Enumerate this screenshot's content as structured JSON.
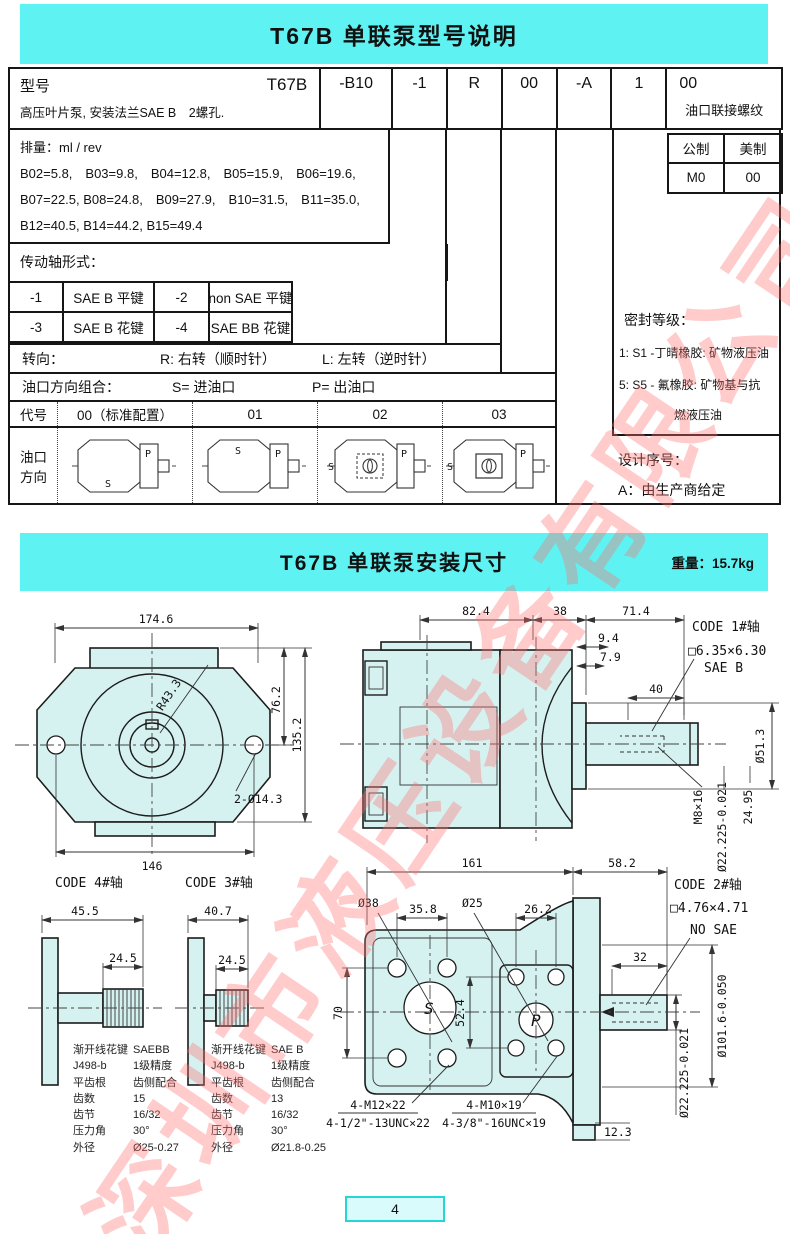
{
  "watermark": "深圳市液压设备有限公司",
  "section1": {
    "title": "T67B 单联泵型号说明",
    "header": {
      "model_label": "型号",
      "model_value": "T67B",
      "desc": "高压叶片泵, 安装法兰SAE B　2螺孔.",
      "codes": [
        "-B10",
        "-1",
        "R",
        "00",
        "-A",
        "1",
        "00"
      ],
      "port_thread_label": "油口联接螺纹"
    },
    "displacement": {
      "lines": [
        "排量：ml / rev",
        "B02=5.8,　B03=9.8,　B04=12.8,　B05=15.9,　B06=19.6,",
        "B07=22.5, B08=24.8,　B09=27.9,　B10=31.5,　B11=35.0,",
        "B12=40.5, B14=44.2, B15=49.4"
      ]
    },
    "shaft": {
      "label": "传动轴形式：",
      "rows": [
        [
          "-1",
          "SAE B 平键",
          "-2",
          "non SAE 平键"
        ],
        [
          "-3",
          "SAE B 花键",
          "-4",
          "SAE BB 花键"
        ]
      ]
    },
    "rotation": {
      "label": "转向：",
      "right": "R: 右转（顺时针）",
      "left": "L: 左转（逆时针）"
    },
    "ports": {
      "label": "油口方向组合：",
      "s": "S= 进油口",
      "p": "P= 出油口"
    },
    "code_row": [
      "代号",
      "00（标准配置）",
      "01",
      "02",
      "03"
    ],
    "port_dir_label_1": "油口",
    "port_dir_label_2": "方向",
    "port_letters": {
      "s": "S",
      "p": "P"
    },
    "thread_table": {
      "metric": "公制",
      "us": "美制",
      "metric_value": "M0",
      "us_value": "00"
    },
    "seal": {
      "title": "密封等级：",
      "line1": "1: S1 -丁晴橡胶: 矿物液压油",
      "line2": "5: S5 - 氟橡胶: 矿物基与抗",
      "line3": "燃液压油"
    },
    "design": {
      "title": "设计序号：",
      "value": "A：由生产商给定"
    }
  },
  "section2": {
    "title": "T67B 单联泵安装尺寸",
    "weight": "重量：15.7kg",
    "dims": {
      "front_w": "174.6",
      "front_h76": "76.2",
      "front_h135": "135.2",
      "front_146": "146",
      "front_holes": "2-Ø14.3",
      "front_r": "R43.3",
      "side_824": "82.4",
      "side_38": "38",
      "side_714": "71.4",
      "side_94": "9.4",
      "side_79": "7.9",
      "side_40": "40",
      "side_d513": "Ø51.3",
      "side_m8": "M8×16",
      "side_d22": "Ø22.225-0.021",
      "side_2495": "24.95",
      "code1": "CODE 1#轴",
      "key1": "□6.35×6.30",
      "saeb": "SAE B",
      "c4_title": "CODE 4#轴",
      "c4_455": "45.5",
      "c4_245": "24.5",
      "c3_title": "CODE 3#轴",
      "c3_407": "40.7",
      "c3_245": "24.5",
      "bot_161": "161",
      "bot_582": "58.2",
      "bot_d38": "Ø38",
      "bot_358": "35.8",
      "bot_d25": "Ø25",
      "bot_262": "26.2",
      "code2": "CODE 2#轴",
      "key2": "□4.76×4.71",
      "nosae": "NO SAE",
      "bot_32": "32",
      "bot_70": "70",
      "bot_524": "52.4",
      "bot_d22": "Ø22.225-0.021",
      "bot_d101": "Ø101.6-0.050",
      "bot_m12": "4-M12×22",
      "bot_unc12": "4-1/2\"-13UNC×22",
      "bot_m10": "4-M10×19",
      "bot_unc10": "4-3/8\"-16UNC×19",
      "bot_123": "12.3",
      "s": "S",
      "p": "P"
    },
    "spline4": {
      "rows": [
        [
          "渐开线花键",
          "SAEBB"
        ],
        [
          "J498-b",
          "1级精度"
        ],
        [
          "平齿根",
          "齿侧配合"
        ],
        [
          "齿数",
          "15"
        ],
        [
          "齿节",
          "16/32"
        ],
        [
          "压力角",
          "30°"
        ],
        [
          "外径",
          "Ø25-0.27"
        ]
      ]
    },
    "spline3": {
      "rows": [
        [
          "渐开线花键",
          "SAE B"
        ],
        [
          "J498-b",
          "1级精度"
        ],
        [
          "平齿根",
          "齿侧配合"
        ],
        [
          "齿数",
          "13"
        ],
        [
          "齿节",
          "16/32"
        ],
        [
          "压力角",
          "30°"
        ],
        [
          "外径",
          "Ø21.8-0.25"
        ]
      ]
    }
  },
  "footer": {
    "page": "4"
  }
}
